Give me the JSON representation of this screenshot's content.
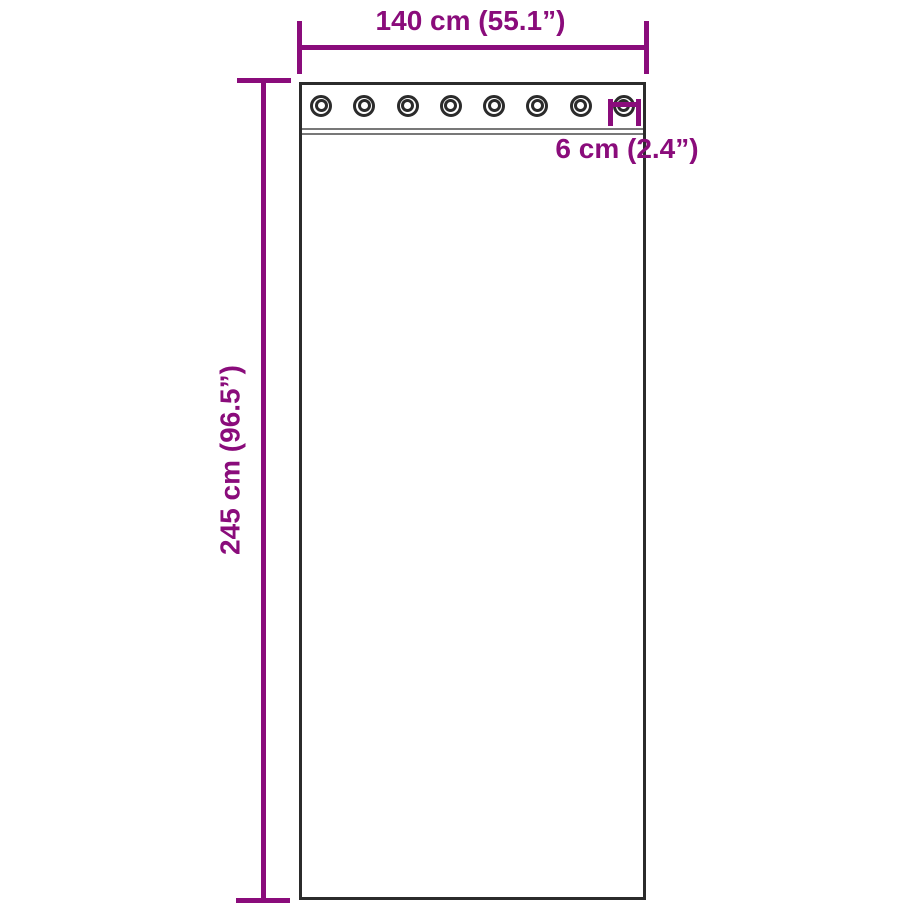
{
  "diagram": {
    "name": "curtain-with-grommets-dimension-diagram",
    "background": "#ffffff",
    "colors": {
      "dimension": "#8a0c7b",
      "outline": "#2b2b2b",
      "stitch": "#787878"
    },
    "width_dimension": {
      "label": "140 cm (55.1”)"
    },
    "height_dimension": {
      "label": "245 cm (96.5”)"
    },
    "grommet_dimension": {
      "label": "6 cm (2.4”)"
    },
    "grommets": {
      "count": 8
    }
  }
}
